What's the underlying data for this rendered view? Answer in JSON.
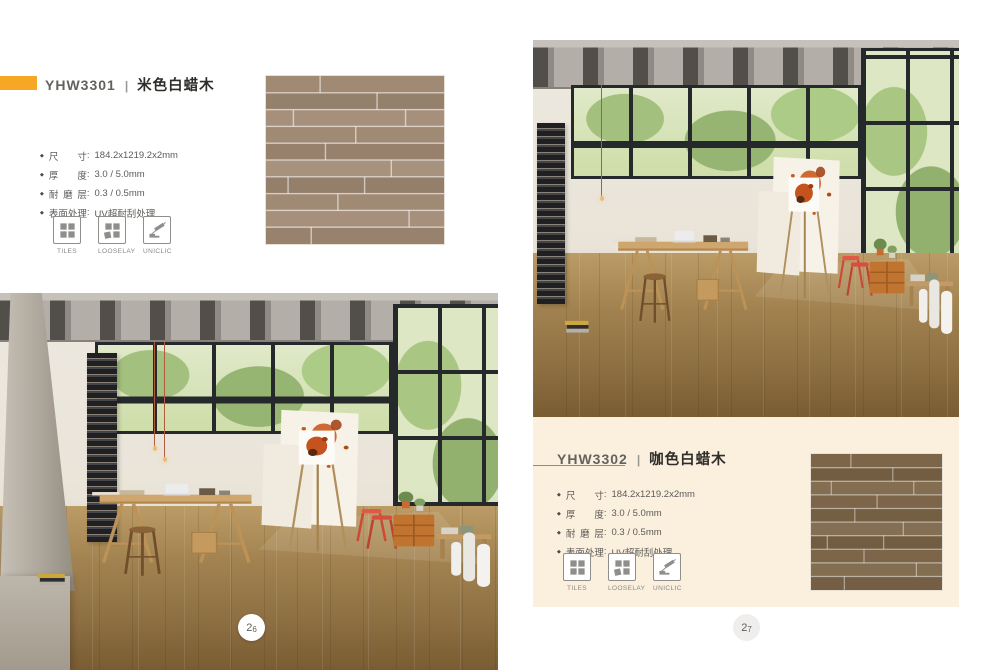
{
  "colors": {
    "accent": "#f6a723",
    "panel": "#fbf0de",
    "swatch-beige": "#a18a74",
    "swatch-coffee": "#7c6548"
  },
  "products": {
    "left": {
      "code": "YHW3301",
      "separator": "|",
      "name": "米色白蜡木",
      "specs": [
        {
          "label": "尺寸",
          "colon": ":",
          "value": "184.2x1219.2x2mm"
        },
        {
          "label": "厚度",
          "colon": ":",
          "value": "3.0 / 5.0mm"
        },
        {
          "label": "耐磨层",
          "colon": ":",
          "value": "0.3 / 0.5mm"
        },
        {
          "label": "表面处理",
          "colon": ":",
          "value": "UV超耐刮处理"
        }
      ],
      "features": [
        {
          "icon": "tiles-icon",
          "label": "TILES"
        },
        {
          "icon": "looselay-icon",
          "label": "LOOSELAY"
        },
        {
          "icon": "uniclic-icon",
          "label": "UNICLIC"
        }
      ],
      "page_number": {
        "first": "2",
        "second": "6"
      }
    },
    "right": {
      "code": "YHW3302",
      "separator": "|",
      "name": "咖色白蜡木",
      "specs": [
        {
          "label": "尺寸",
          "colon": ":",
          "value": "184.2x1219.2x2mm"
        },
        {
          "label": "厚度",
          "colon": ":",
          "value": "3.0 / 5.0mm"
        },
        {
          "label": "耐磨层",
          "colon": ":",
          "value": "0.3 / 0.5mm"
        },
        {
          "label": "表面处理",
          "colon": ":",
          "value": "UV超耐刮处理"
        }
      ],
      "features": [
        {
          "icon": "tiles-icon",
          "label": "TILES"
        },
        {
          "icon": "looselay-icon",
          "label": "LOOSELAY"
        },
        {
          "icon": "uniclic-icon",
          "label": "UNICLIC"
        }
      ],
      "page_number": {
        "first": "2",
        "second": "7"
      }
    }
  }
}
